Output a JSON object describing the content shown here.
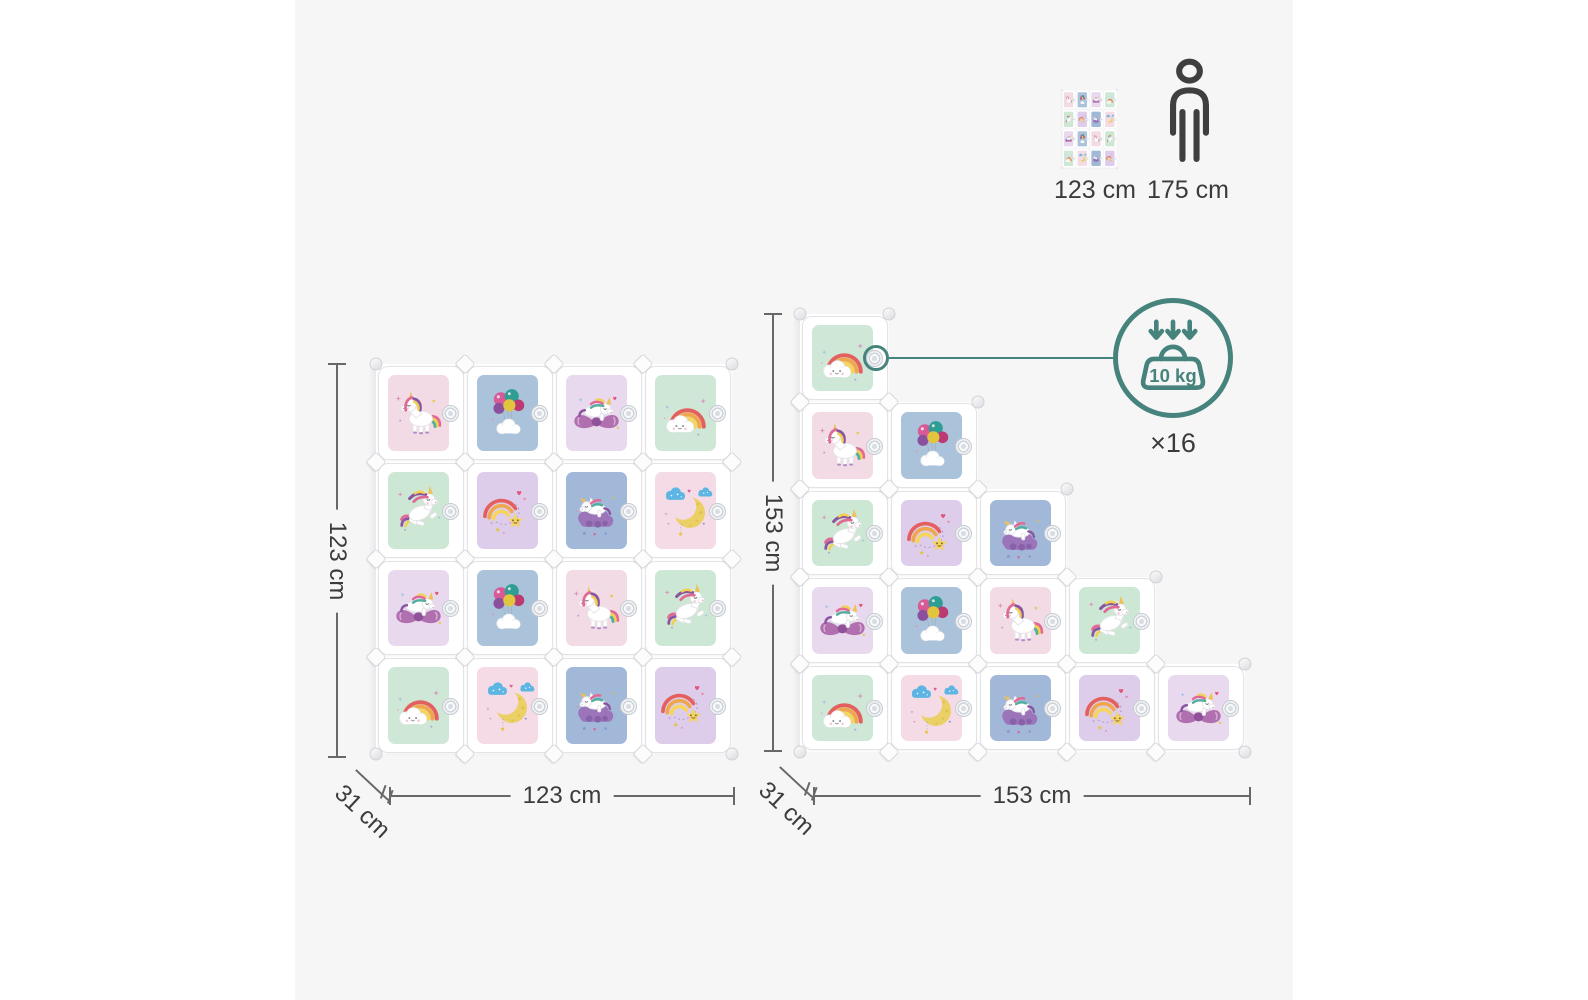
{
  "canvas": {
    "background": "#f6f6f6",
    "accent_teal": "#47837d"
  },
  "size_reference": {
    "unit": {
      "icon": "cabinet-thumbnail",
      "label": "123 cm"
    },
    "person": {
      "icon": "person-icon",
      "label": "175 cm"
    }
  },
  "capacity_badge": {
    "icon": "weight-load-icon",
    "weight_label": "10 kg",
    "quantity_label": "×16"
  },
  "cube_types": {
    "unicorn_standing": {
      "bg": "#f2dbe4",
      "icon": "unicorn-standing-icon"
    },
    "balloons": {
      "bg": "#abc3da",
      "icon": "balloons-cloud-icon"
    },
    "unicorn_bow": {
      "bg": "#e9d9ee",
      "icon": "unicorn-on-bow-icon"
    },
    "rainbow_cloud": {
      "bg": "#cfe7d7",
      "icon": "rainbow-cloud-icon"
    },
    "unicorn_prancing": {
      "bg": "#cde7d5",
      "icon": "unicorn-prancing-icon"
    },
    "rainbow_star": {
      "bg": "#ddccea",
      "icon": "rainbow-shooting-star-icon"
    },
    "unicorn_cloud": {
      "bg": "#a2b8d8",
      "icon": "unicorn-sleeping-cloud-icon"
    },
    "moon": {
      "bg": "#f4dbe5",
      "icon": "moon-clouds-icon"
    }
  },
  "left_unit": {
    "height_label": "123 cm",
    "width_label": "123 cm",
    "depth_label": "31 cm",
    "rows": [
      [
        "unicorn_standing",
        "balloons",
        "unicorn_bow",
        "rainbow_cloud"
      ],
      [
        "unicorn_prancing",
        "rainbow_star",
        "unicorn_cloud",
        "moon"
      ],
      [
        "unicorn_bow",
        "balloons",
        "unicorn_standing",
        "unicorn_prancing"
      ],
      [
        "rainbow_cloud",
        "moon",
        "unicorn_cloud",
        "rainbow_star"
      ]
    ]
  },
  "right_unit": {
    "height_label": "153 cm",
    "width_label": "153 cm",
    "depth_label": "31 cm",
    "rows": [
      [
        "rainbow_cloud",
        null,
        null,
        null,
        null
      ],
      [
        "unicorn_standing",
        "balloons",
        null,
        null,
        null
      ],
      [
        "unicorn_prancing",
        "rainbow_star",
        "unicorn_cloud",
        null,
        null
      ],
      [
        "unicorn_bow",
        "balloons",
        "unicorn_standing",
        "unicorn_prancing",
        null
      ],
      [
        "rainbow_cloud",
        "moon",
        "unicorn_cloud",
        "rainbow_star",
        "unicorn_bow"
      ]
    ]
  }
}
